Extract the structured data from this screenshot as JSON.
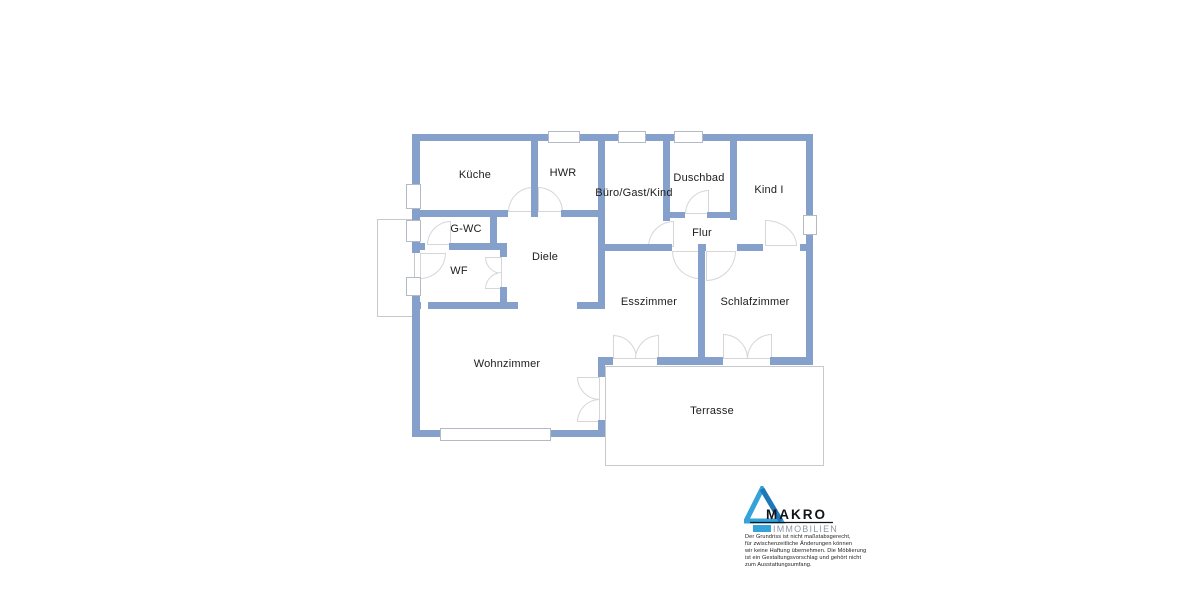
{
  "floorplan": {
    "rooms": {
      "kueche": "Küche",
      "hwr": "HWR",
      "buero": "Büro/Gast/Kind",
      "duschbad": "Duschbad",
      "kind1": "Kind I",
      "gwc": "G-WC",
      "flur": "Flur",
      "diele": "Diele",
      "wf": "WF",
      "esszimmer": "Esszimmer",
      "schlafzimmer": "Schlafzimmer",
      "wohnzimmer": "Wohnzimmer",
      "terrasse": "Terrasse"
    },
    "wall_color": "#85a0ca"
  },
  "branding": {
    "logo_name": "MAKRO",
    "logo_subtitle": "IMMOBILIEN",
    "logo_triangle_color": "#35a3d9",
    "logo_triangle_dark": "#1f77b8",
    "logo_subtitle_color": "#8b98a6",
    "disclaimer": [
      "Der Grundriss ist nicht maßstabsgerecht,",
      "für zwischenzeitliche Änderungen können",
      "wir keine Haftung übernehmen. Die Möblierung",
      "ist ein Gestaltungsvorschlag und gehört nicht",
      "zum Ausstattungsumfang."
    ]
  }
}
